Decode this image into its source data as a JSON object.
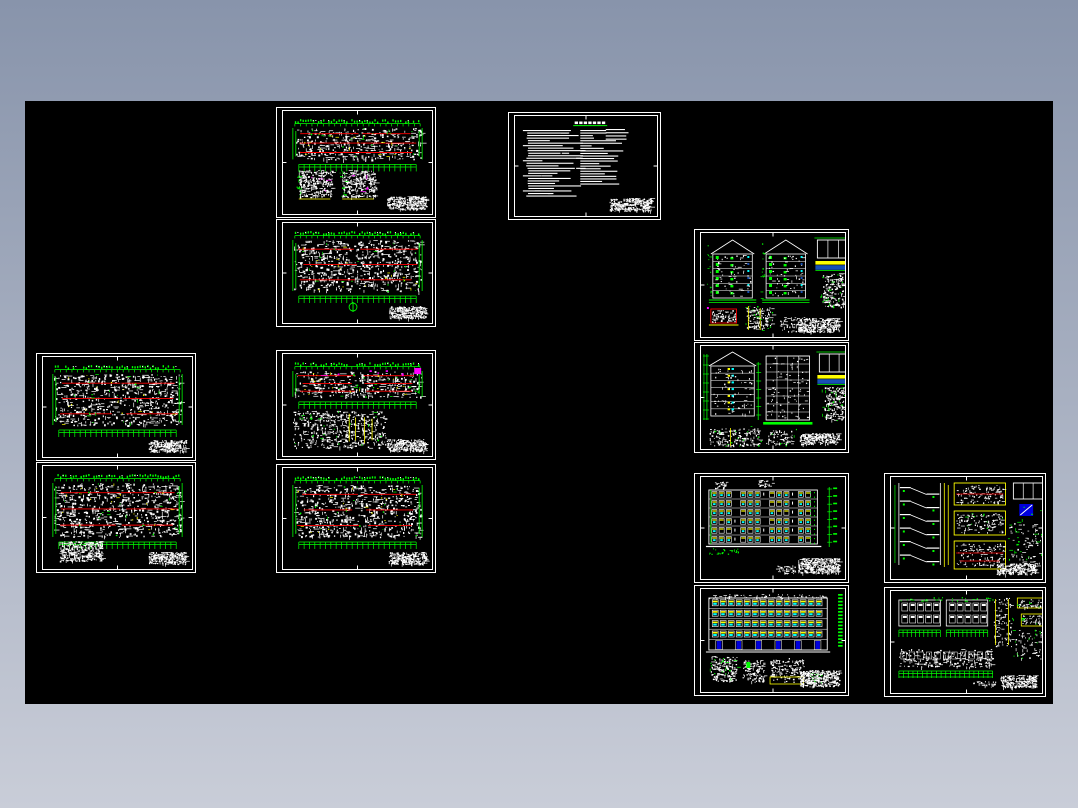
{
  "window": {
    "background_top": "#8894ab",
    "background_bottom": "#c9cdd8"
  },
  "canvas": {
    "x": 25,
    "y": 101,
    "width": 1028,
    "height": 603,
    "background": "#000000"
  },
  "palette": {
    "frame": "#ffffff",
    "white": "#ffffff",
    "green": "#00ff00",
    "red": "#ff0000",
    "yellow": "#ffff00",
    "magenta": "#ff00ff",
    "cyan": "#00ffff",
    "blue": "#1750b4",
    "deep_blue": "#0000dd"
  },
  "sheets": [
    {
      "id": "first-floor-plan",
      "kind": "plan-with-details",
      "x": 276,
      "y": 107,
      "w": 160,
      "h": 111,
      "seed": 11
    },
    {
      "id": "standard-floor-plan",
      "kind": "plan-north",
      "x": 276,
      "y": 219,
      "w": 160,
      "h": 108,
      "seed": 22
    },
    {
      "id": "design-notes",
      "kind": "notes",
      "x": 508,
      "y": 112,
      "w": 153,
      "h": 108,
      "seed": 33
    },
    {
      "id": "side-gable-elevations",
      "kind": "gable-elevations",
      "x": 694,
      "y": 229,
      "w": 155,
      "h": 112,
      "seed": 44
    },
    {
      "id": "building-section",
      "kind": "section-elevation",
      "x": 694,
      "y": 342,
      "w": 155,
      "h": 111,
      "seed": 55
    },
    {
      "id": "floor-plan-west-a",
      "kind": "plan",
      "x": 36,
      "y": 353,
      "w": 160,
      "h": 108,
      "seed": 66
    },
    {
      "id": "floor-plan-west-b",
      "kind": "plan-textblock",
      "x": 36,
      "y": 462,
      "w": 160,
      "h": 111,
      "seed": 77
    },
    {
      "id": "roof-plan",
      "kind": "roof-plan",
      "x": 276,
      "y": 350,
      "w": 160,
      "h": 110,
      "seed": 88
    },
    {
      "id": "floor-plan-mid",
      "kind": "plan",
      "x": 276,
      "y": 464,
      "w": 160,
      "h": 109,
      "seed": 99
    },
    {
      "id": "front-elevation",
      "kind": "front-elevation",
      "x": 694,
      "y": 473,
      "w": 155,
      "h": 110,
      "seed": 111
    },
    {
      "id": "rear-elevation",
      "kind": "rear-elevation",
      "x": 694,
      "y": 585,
      "w": 155,
      "h": 111,
      "seed": 122
    },
    {
      "id": "stair-section-details",
      "kind": "stair-details",
      "x": 884,
      "y": 473,
      "w": 162,
      "h": 110,
      "seed": 133
    },
    {
      "id": "partial-elev-details",
      "kind": "partial-elevations",
      "x": 884,
      "y": 587,
      "w": 162,
      "h": 110,
      "seed": 144
    }
  ]
}
